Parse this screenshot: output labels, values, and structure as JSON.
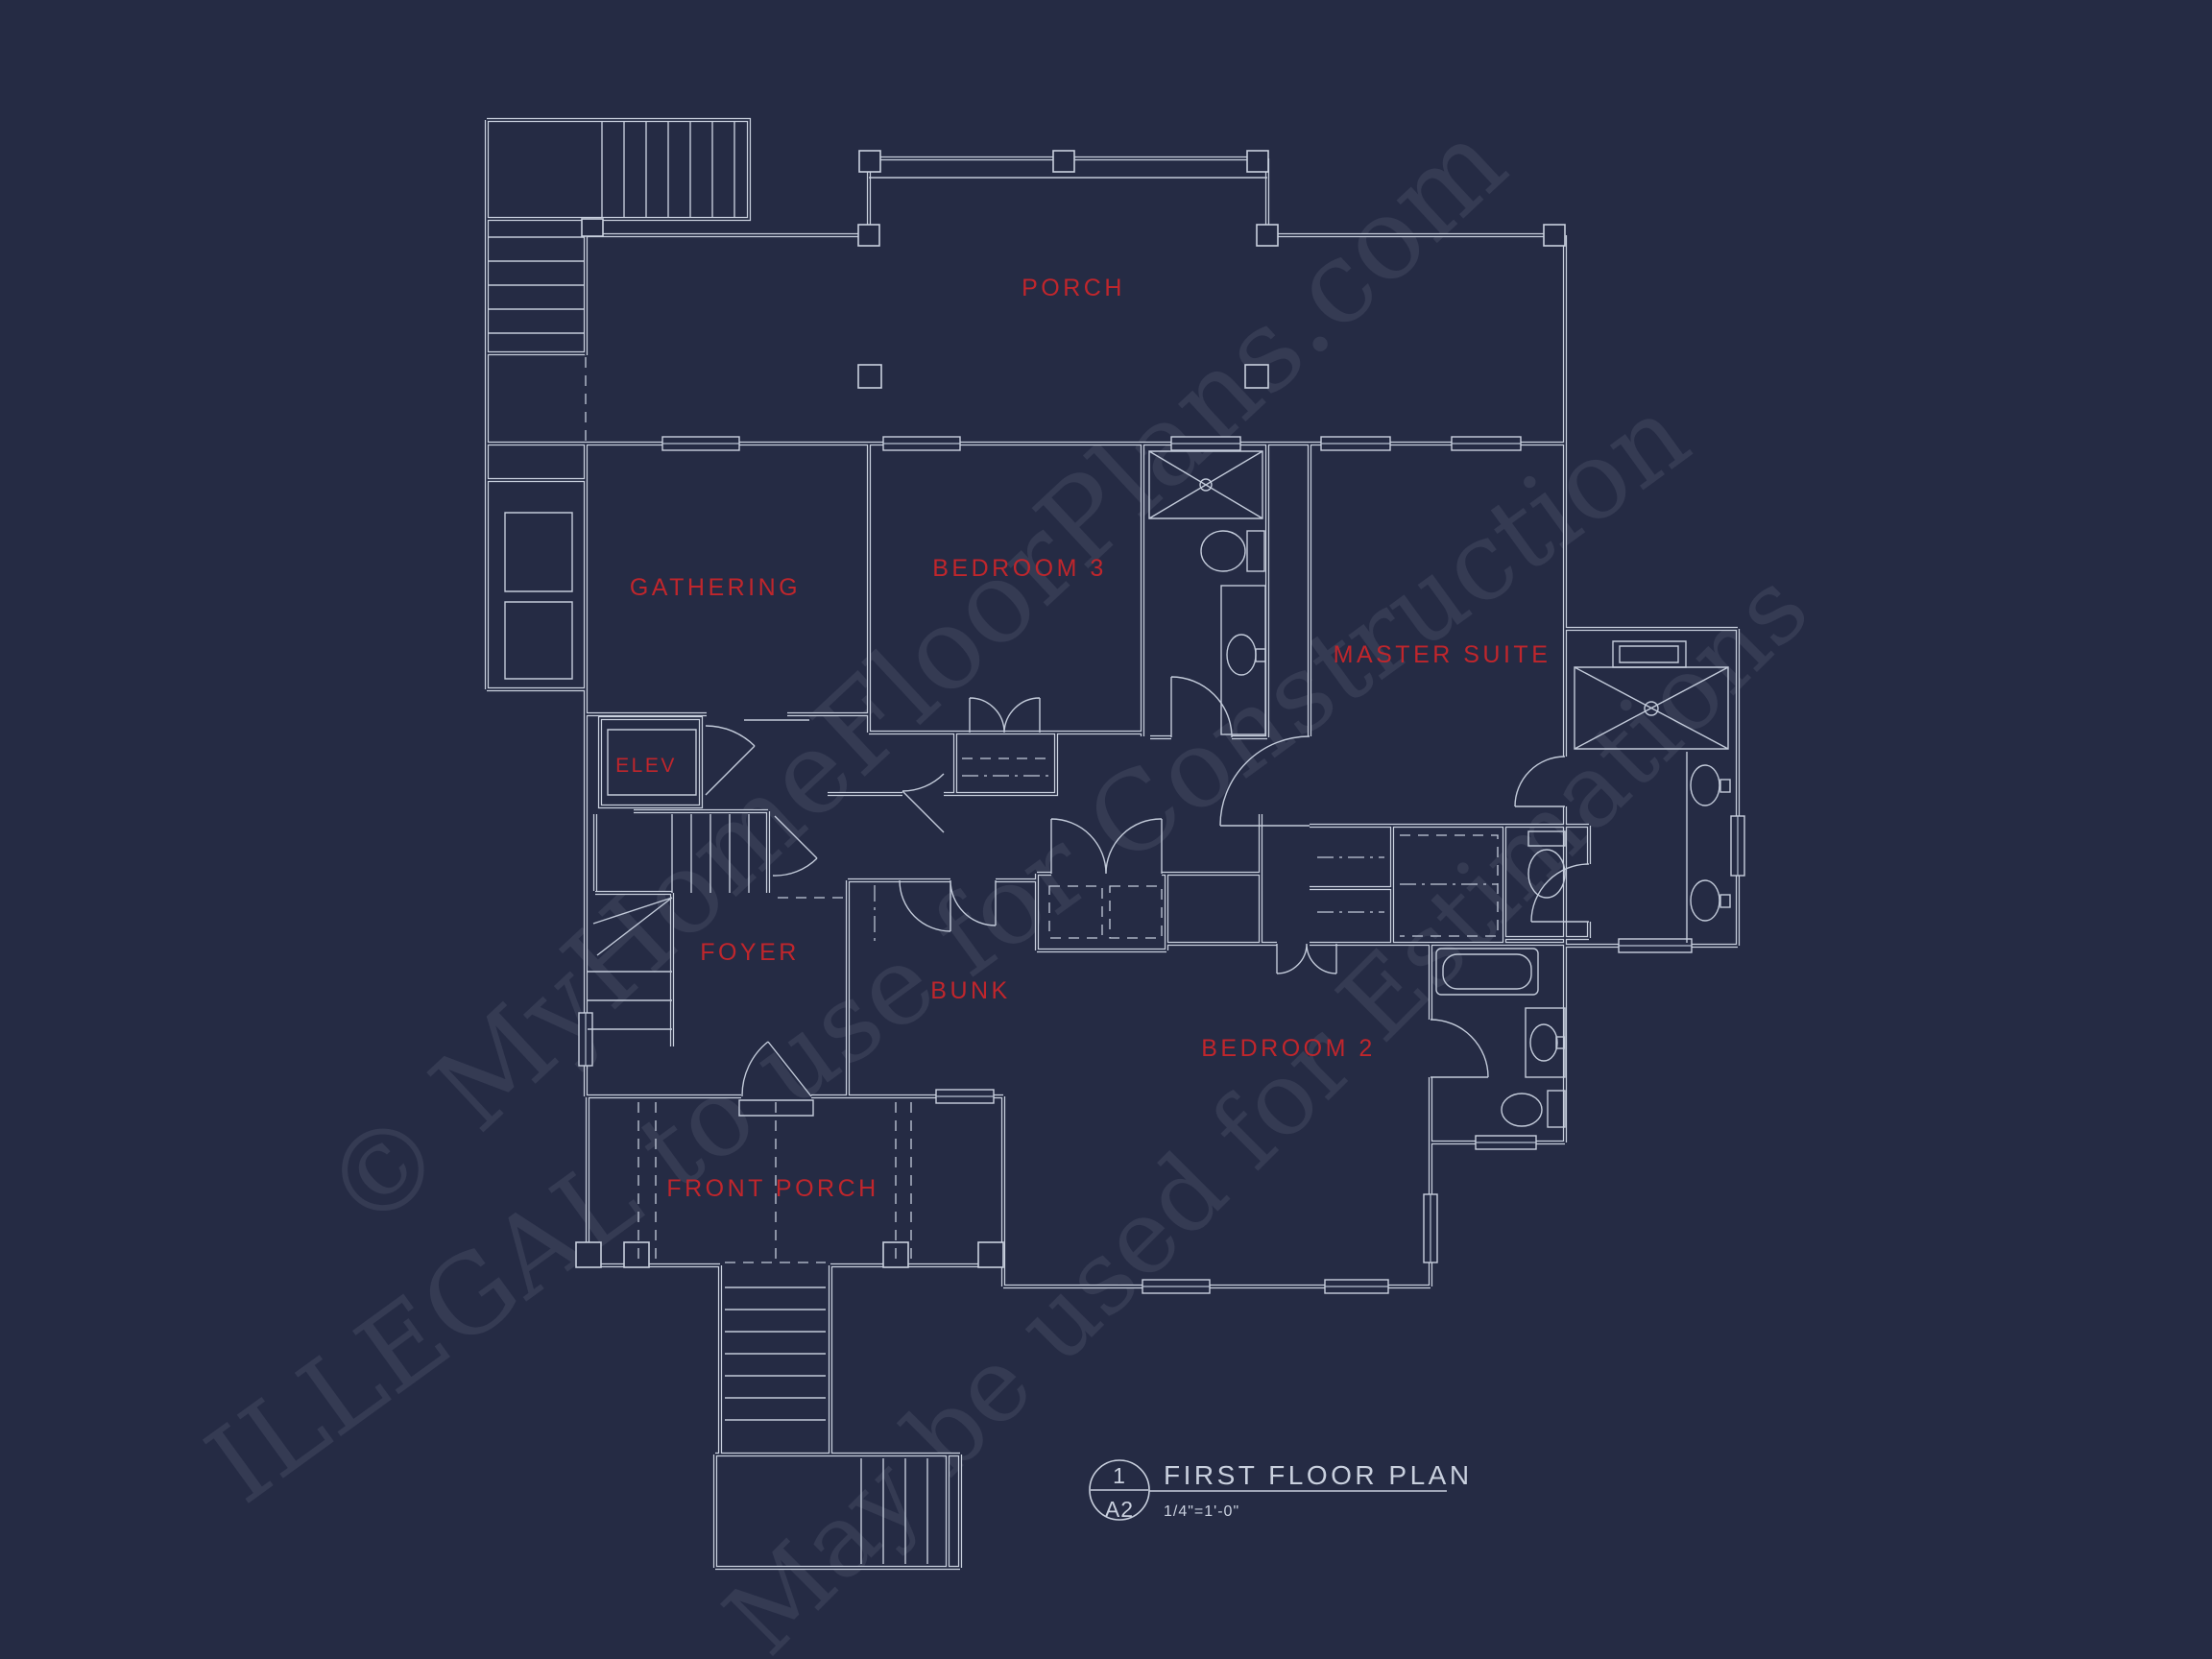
{
  "drawing": {
    "type": "architectural floor plan, blueprint style",
    "colors": {
      "background": "#252b44",
      "lines": "#c9d0de",
      "label_red": "#c0262c",
      "watermark": "#b9c3da"
    }
  },
  "watermark_lines": [
    "© MyHomeFloorPlans.com",
    "ILLEGAL to use for Construction",
    "May be used for Estimations"
  ],
  "rooms": [
    {
      "id": "porch",
      "label": "PORCH"
    },
    {
      "id": "gathering",
      "label": "GATHERING"
    },
    {
      "id": "bedroom-3",
      "label": "BEDROOM 3"
    },
    {
      "id": "master-suite",
      "label": "MASTER SUITE"
    },
    {
      "id": "elev",
      "label": "ELEV"
    },
    {
      "id": "foyer",
      "label": "FOYER"
    },
    {
      "id": "bunk",
      "label": "BUNK"
    },
    {
      "id": "bedroom-2",
      "label": "BEDROOM 2"
    },
    {
      "id": "front-porch",
      "label": "FRONT PORCH"
    }
  ],
  "title_block": {
    "detail_number": "1",
    "sheet_number": "A2",
    "title": "FIRST FLOOR PLAN",
    "scale": "1/4\"=1'-0\""
  }
}
